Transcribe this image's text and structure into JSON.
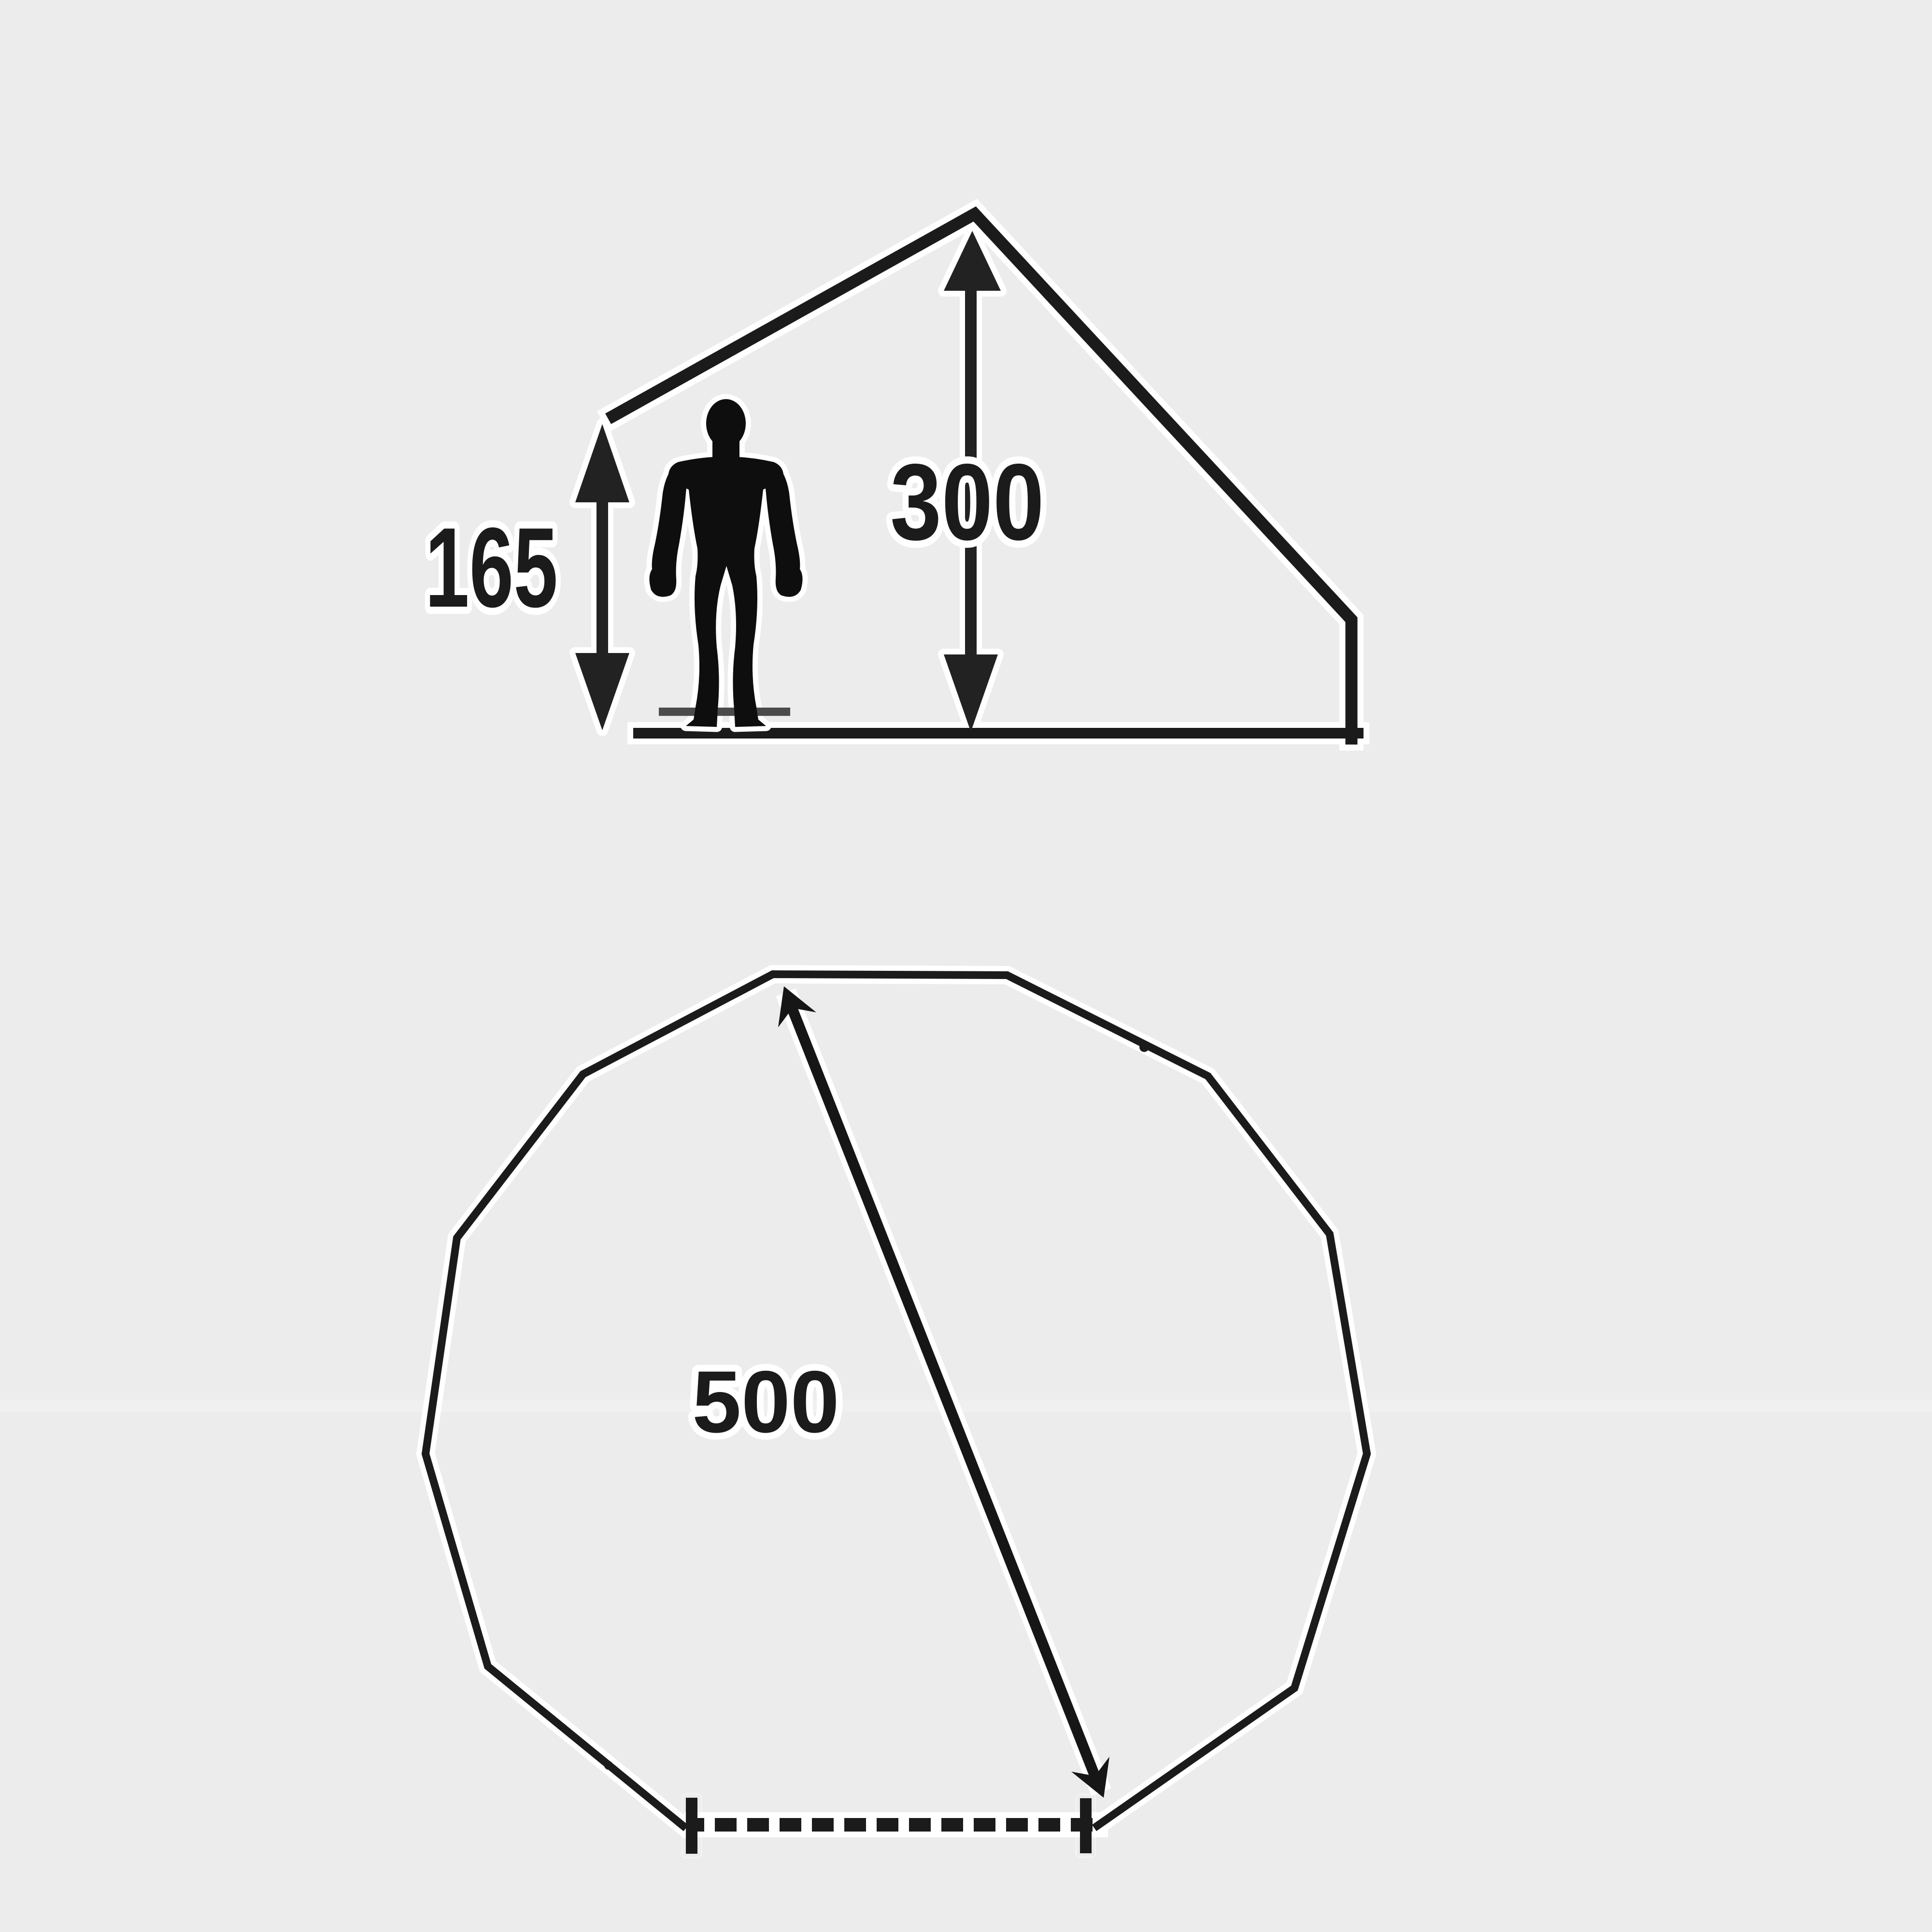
{
  "page": {
    "background": "#ececec",
    "description_labels_present": [
      "165",
      "300",
      "500"
    ]
  },
  "palette": {
    "ink": "#1b1b1b",
    "halo": "#ffffff",
    "figure": "#0e0e0e",
    "base_plate": "#4b4b4b",
    "bg_seam": "#f3f3f3"
  },
  "side_profile_diagram": {
    "peak_height_label": "300",
    "eave_height_label": "165"
  },
  "floor_plan_diagram": {
    "diameter_label": "500",
    "polygon_sides": 12
  }
}
